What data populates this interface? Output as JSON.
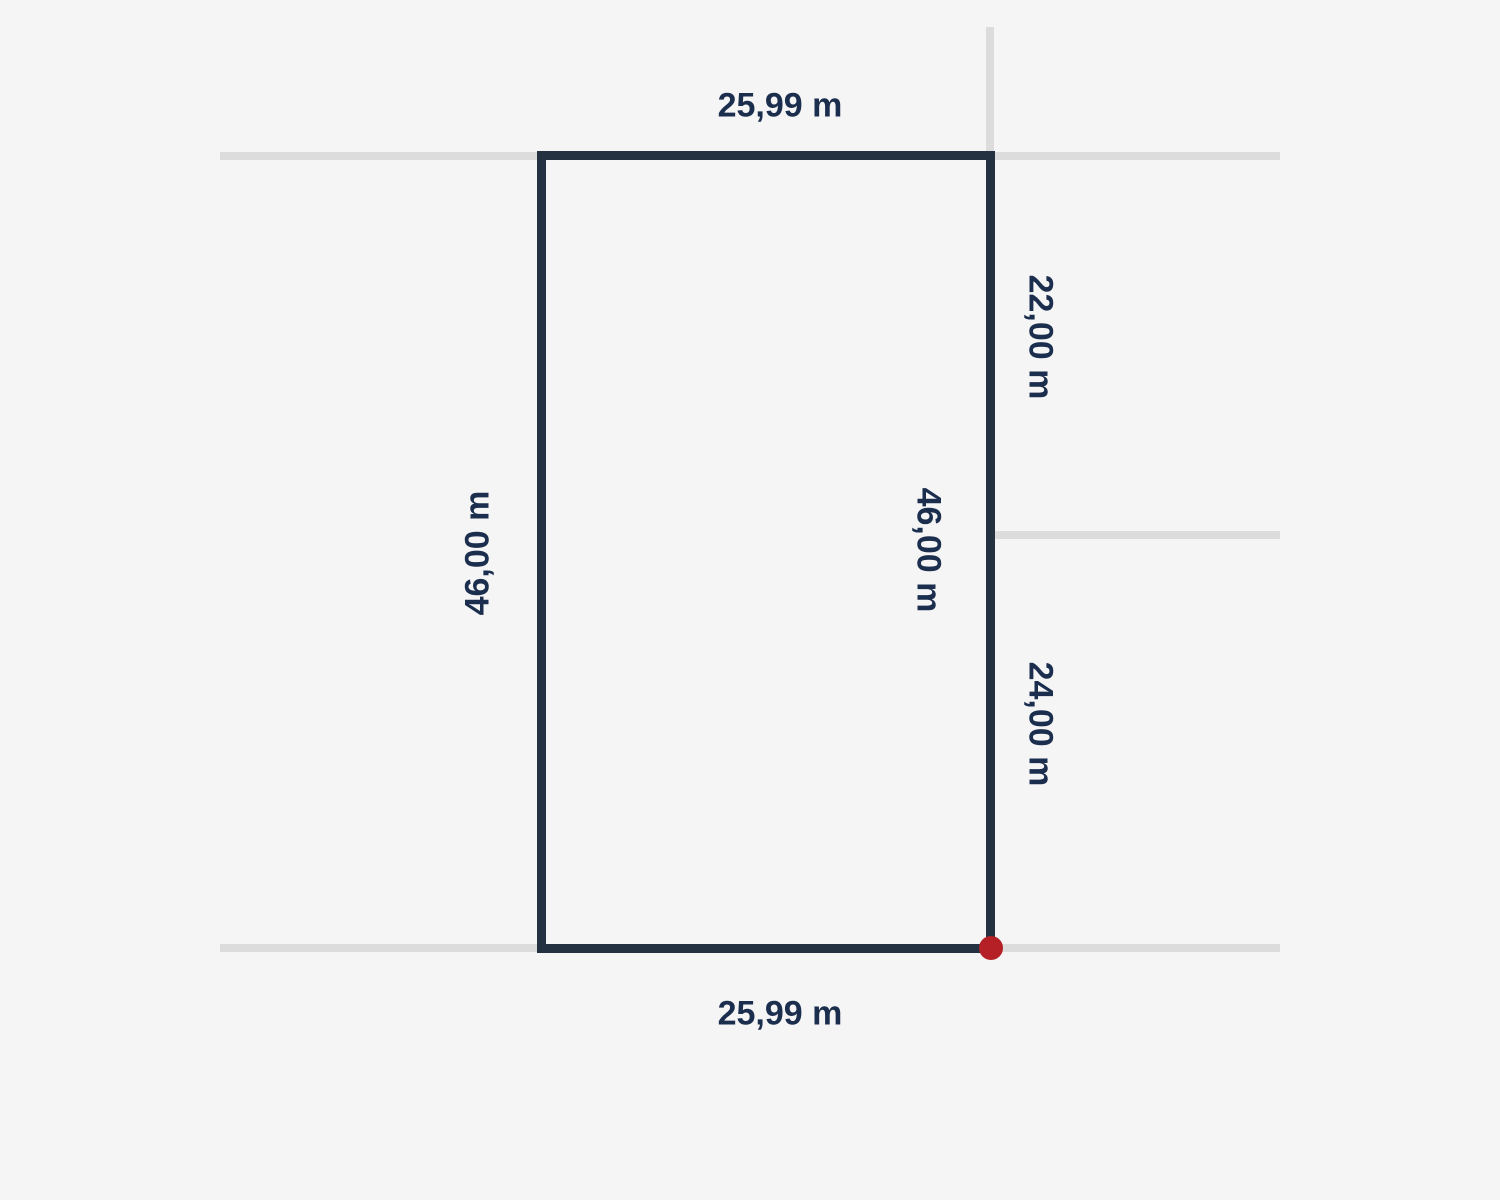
{
  "diagram": {
    "type": "land-plot-measurement",
    "labels": {
      "top_width": "25,99 m",
      "bottom_width": "25,99 m",
      "left_depth": "46,00 m",
      "right_depth": "46,00 m",
      "right_upper_segment": "22,00 m",
      "right_lower_segment": "24,00 m"
    },
    "colors": {
      "background": "#f5f5f6",
      "boundary": "#233140",
      "neighbor_line": "#dcdcdc",
      "label_text": "#1b2e4d",
      "corner_marker": "#b42025"
    }
  }
}
